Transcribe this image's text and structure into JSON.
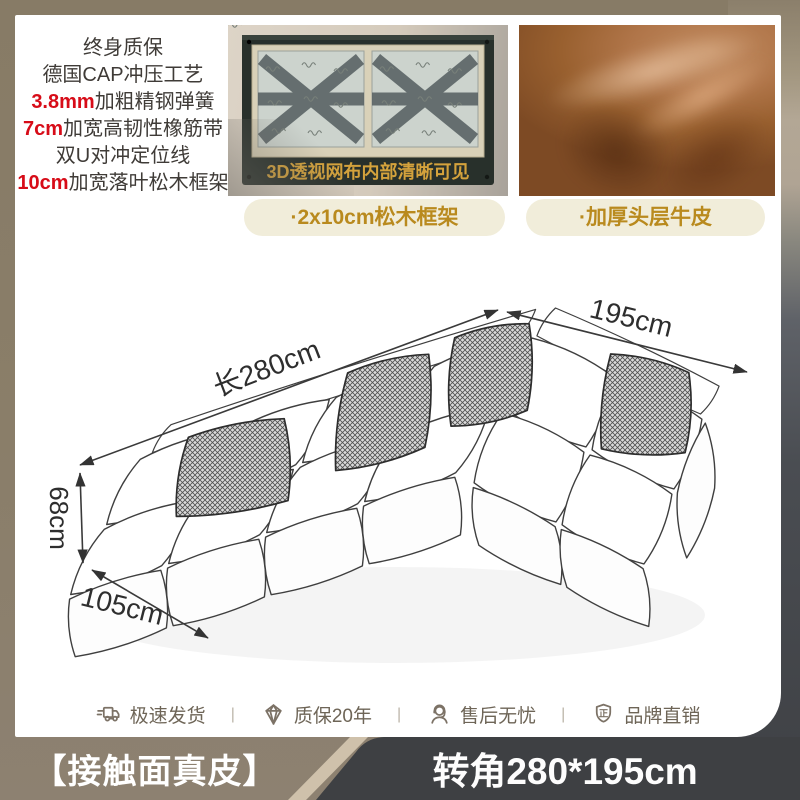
{
  "colors": {
    "accent_red": "#d70c18",
    "gold_text": "#b98a1e",
    "badge_bg": "#f1edda",
    "overlay_gold": "#d4a23c",
    "frame_green": "#28302b",
    "leather_brown": "#a76a40",
    "panel_dark": "#3e4043",
    "panel_stripe": "#cfc1ab",
    "bar_taupe": "#8d8171",
    "service_ink": "#6e6557",
    "ink": "#3f3b37",
    "card_bg": "#ffffff"
  },
  "features": {
    "lines": [
      {
        "em": "",
        "text": "终身质保"
      },
      {
        "em": "",
        "text": "德国CAP冲压工艺"
      },
      {
        "em": "3.8mm",
        "text": "加粗精钢弹簧"
      },
      {
        "em": "7cm",
        "text": "加宽高韧性橡筋带"
      },
      {
        "em": "",
        "text": "双U对冲定位线"
      },
      {
        "em": "10cm",
        "text": "加宽落叶松木框架"
      }
    ]
  },
  "frame_photo": {
    "overlay_text": "3D透视网布内部清晰可见",
    "badge": "·2x10cm松木框架"
  },
  "leather_photo": {
    "badge": "·加厚头层牛皮"
  },
  "diagram": {
    "length_label": "长280cm",
    "width_label": "195cm",
    "height_label": "68cm",
    "depth_label": "105cm"
  },
  "services": [
    {
      "icon": "truck-icon",
      "label": "极速发货"
    },
    {
      "icon": "diamond-icon",
      "label": "质保20年"
    },
    {
      "icon": "headset-icon",
      "label": "售后无忧"
    },
    {
      "icon": "shield-icon",
      "label": "品牌直销"
    }
  ],
  "services_separator": "|",
  "shield_char": "正",
  "bottom_bar": {
    "left": "【接触面真皮】",
    "right": "转角280*195cm"
  }
}
